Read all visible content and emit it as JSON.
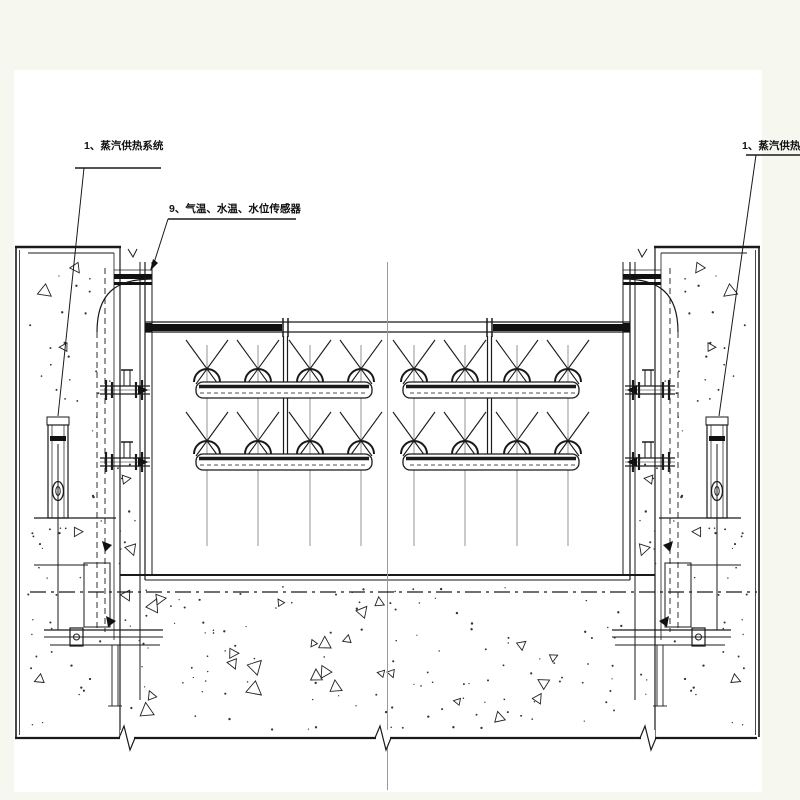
{
  "drawing": {
    "labels": {
      "steam_system_left": "1、蒸汽供热系统",
      "sensors": "9、气温、水温、水位传感器",
      "steam_system_right": "1、蒸汽供热系统"
    },
    "colors": {
      "page_background": "#f6f8ef",
      "paper": "#ffffff",
      "ink": "#1a1a1a",
      "centerline": "#999999"
    }
  }
}
